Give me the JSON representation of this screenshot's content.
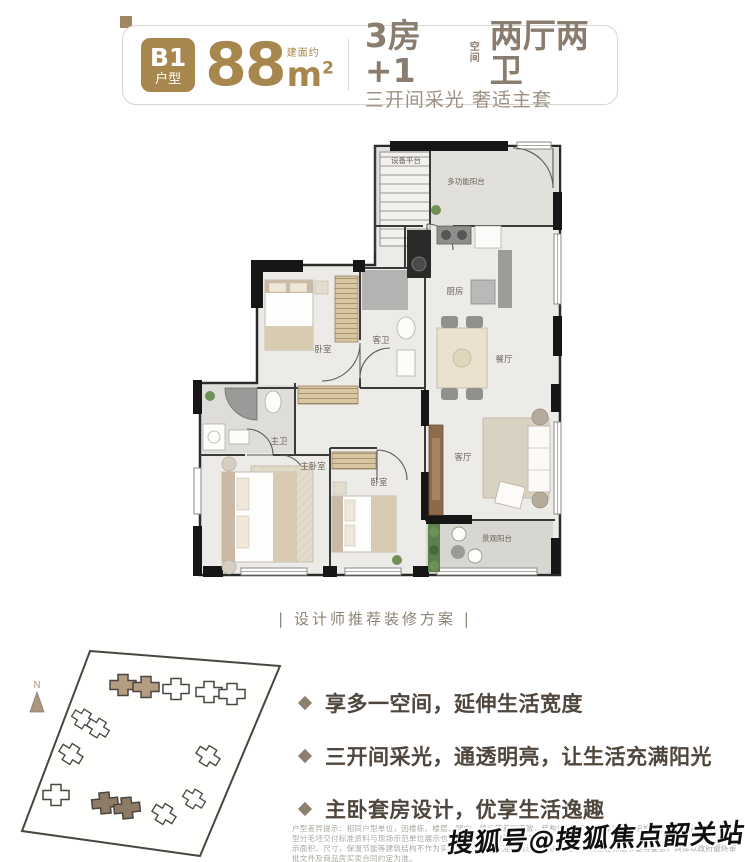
{
  "header": {
    "badge_line1": "B1",
    "badge_line2": "户型",
    "area_number": "88",
    "area_prefix": "建面约",
    "area_unit": "m",
    "area_sup": "2",
    "headline_main": "3房+1",
    "headline_stack_top": "空",
    "headline_stack_bottom": "间",
    "headline_rest": "两厅两卫",
    "subline": "三开间采光 奢适主套"
  },
  "floorplan": {
    "caption": "| 设计师推荐装修方案 |",
    "rooms": {
      "equipment": "设备平台",
      "multi_balcony": "多功能阳台",
      "kitchen": "厨房",
      "guest_bath": "客卫",
      "bedroom_top": "卧室",
      "dining": "餐厅",
      "master_bath": "主卫",
      "master_bedroom": "主卧室",
      "bedroom2": "卧室",
      "living": "客厅",
      "view_balcony": "景观阳台"
    }
  },
  "siteplan": {
    "north_label": "N"
  },
  "selling_points": [
    "享多一空间，延伸生活宽度",
    "三开间采光，通透明亮，让生活充满阳光",
    "主卧套房设计，优享生活逸趣"
  ],
  "disclaimer": {
    "line1": "户型差异提示：相同户型单位，因楼栋、楼层、朝向、单元等差别而致，结构梁柱、面积、保温节能设施等可能存在差异，且各户型分毛坯交付标准资料与现场示范单位展示也有可能存在细微差异，室内所",
    "line2": "示面积、尺寸，保温节能等建筑结构不作为实际交付标准之基准，且示范单位可能存在未包含保温节能等要求，具体以政府最终审批文件及商品房买卖合同约定为准。"
  },
  "watermark": "搜狐号@搜狐焦点韶关站",
  "colors": {
    "gold": "#a7874e",
    "taupe": "#8a7d70",
    "text_dark": "#4f463d"
  }
}
